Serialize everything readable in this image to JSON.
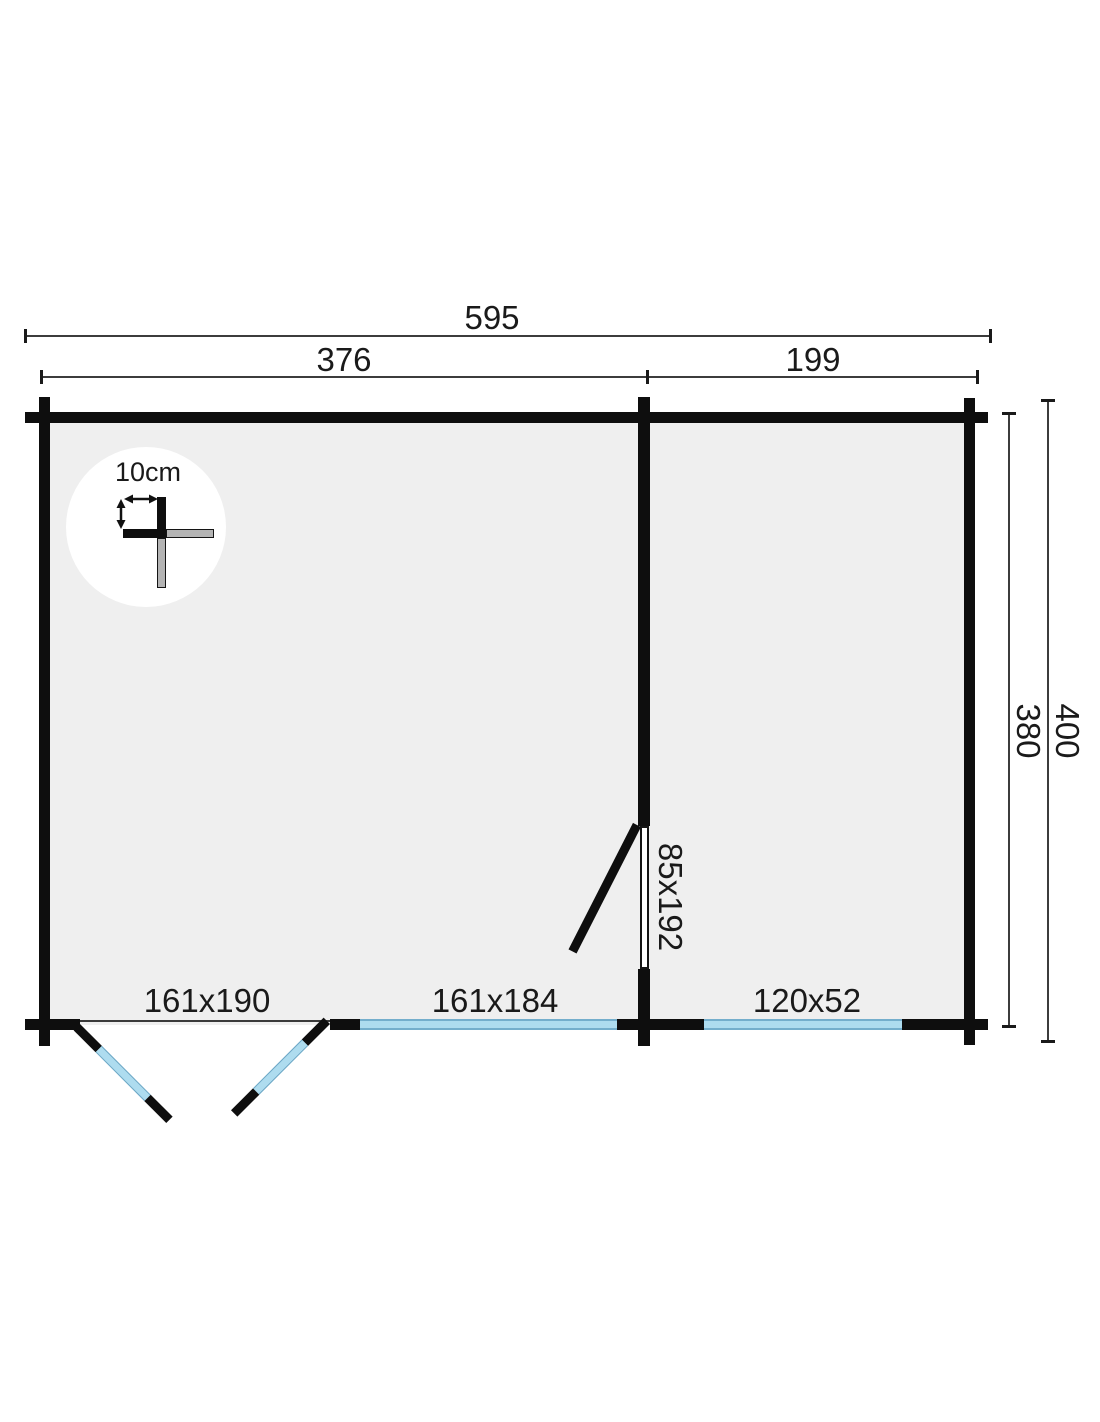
{
  "plan": {
    "dim_total_width": "595",
    "dim_left_section": "376",
    "dim_right_section": "199",
    "dim_inner_depth": "380",
    "dim_outer_depth": "400",
    "wall_thickness_label": "10cm",
    "interior_door_label": "85x192",
    "front_double_door_label": "161x190",
    "large_window_label": "161x184",
    "small_window_label": "120x52"
  },
  "colors": {
    "wall": "#0e0e0e",
    "floor": "#efefef",
    "glazing_fill": "#aedcef",
    "glazing_border": "#74aecc",
    "dimension_line": "#3c3c3c",
    "text": "#1a1a1a"
  }
}
